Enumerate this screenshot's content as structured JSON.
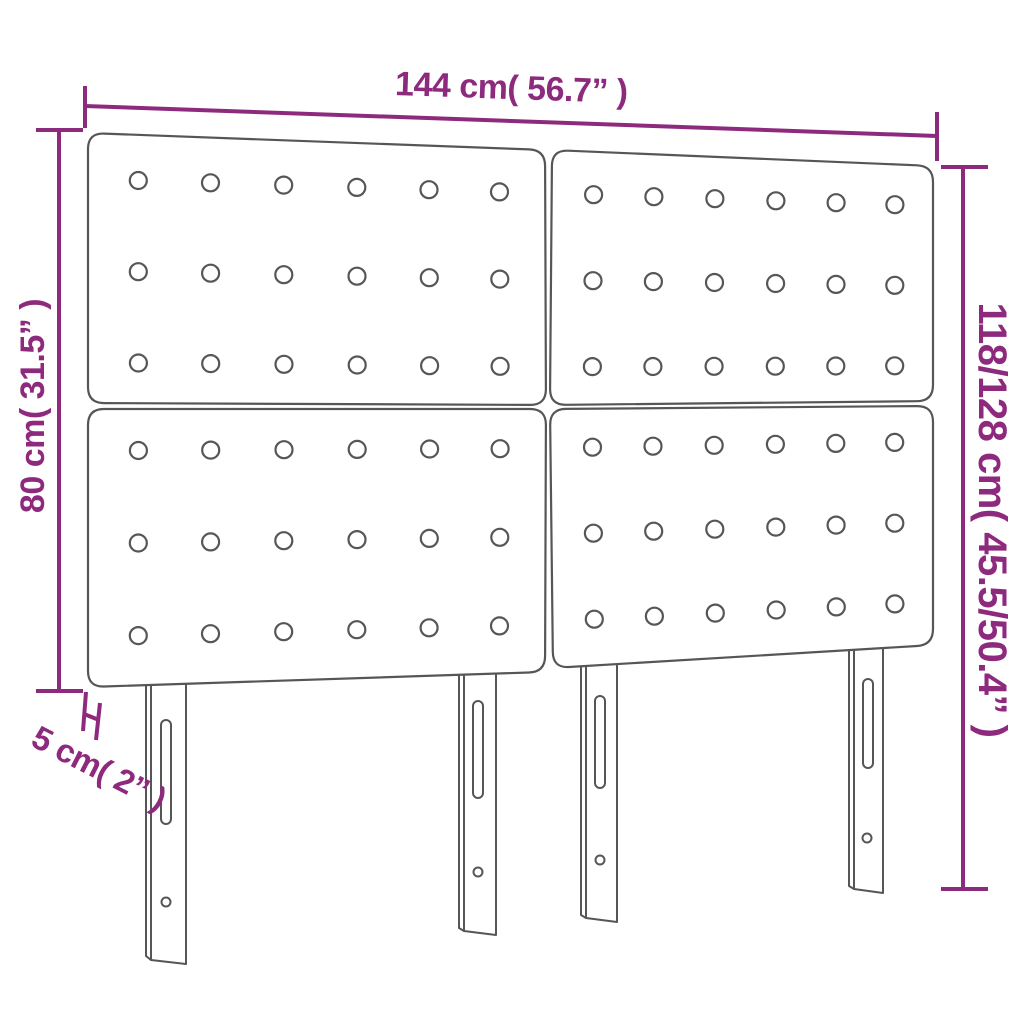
{
  "diagram": {
    "type": "product-dimension-diagram",
    "product": "4-panel tufted headboard with 4 slotted legs",
    "colors": {
      "accent": "#8e2a7d",
      "outline": "#565656",
      "background": "#ffffff"
    },
    "dimensions": {
      "width": {
        "label": "144 cm( 56.7” )"
      },
      "panel_height": {
        "label": "80 cm( 31.5” )"
      },
      "total_height": {
        "label": "118/128 cm( 45.5/50.4” )"
      },
      "thickness": {
        "label": "5 cm( 2” )"
      }
    },
    "structure": {
      "panels": 4,
      "buttons_per_panel": 18,
      "button_grid": "6x3",
      "legs": 4
    }
  }
}
